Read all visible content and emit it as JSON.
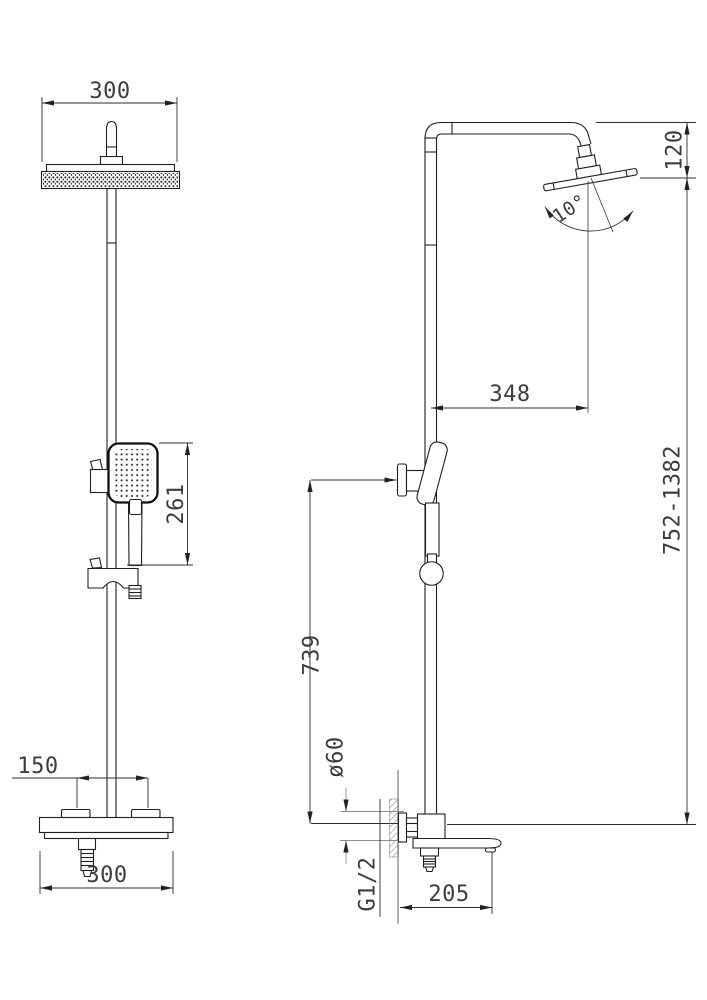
{
  "drawing": {
    "kind": "shower-column-technical-drawing",
    "views": {
      "front": "front-view",
      "side": "side-view"
    }
  },
  "labels": {
    "head_width": "300",
    "head_height_drop": "120",
    "tilt_angle": "10°",
    "horizontal_offset": "348",
    "height_range": "752-1382",
    "hand_shower_length": "261",
    "slide_bar_height": "739",
    "escutcheon_diameter": "ø60",
    "handle_spacing": "150",
    "body_width": "300",
    "spout_reach": "205",
    "inlet_thread": "G1/2"
  }
}
